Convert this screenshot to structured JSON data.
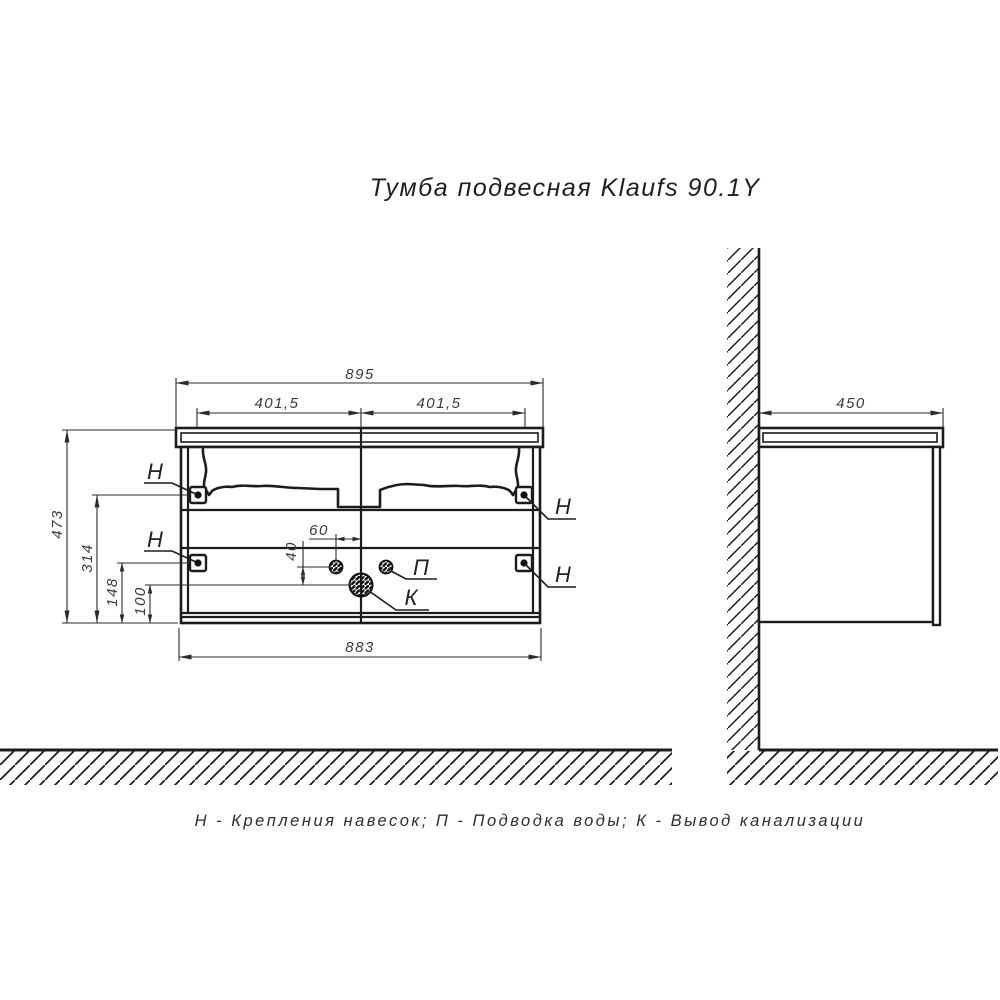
{
  "drawing": {
    "title": "Тумба подвесная Klaufs 90.1Y",
    "legend": "Н - Крепления навесок; П - Подводка воды; К - Вывод канализации",
    "line_color": "#1c1c1c",
    "dim_text_color": "#3a3a3a",
    "background_color": "#ffffff"
  },
  "labels": {
    "bracket": "Н",
    "water_supply": "П",
    "drain": "К"
  },
  "front_view": {
    "dim_total_width_top": "895",
    "dim_half_left": "401,5",
    "dim_half_right": "401,5",
    "dim_total_height": "473",
    "dim_upper_bracket_height": "314",
    "dim_lower_bracket_height": "148",
    "dim_drain_height": "100",
    "dim_cabinet_width_bottom": "883",
    "dim_water_offset": "60",
    "dim_water_drain_gap": "40"
  },
  "side_view": {
    "dim_depth": "450"
  }
}
